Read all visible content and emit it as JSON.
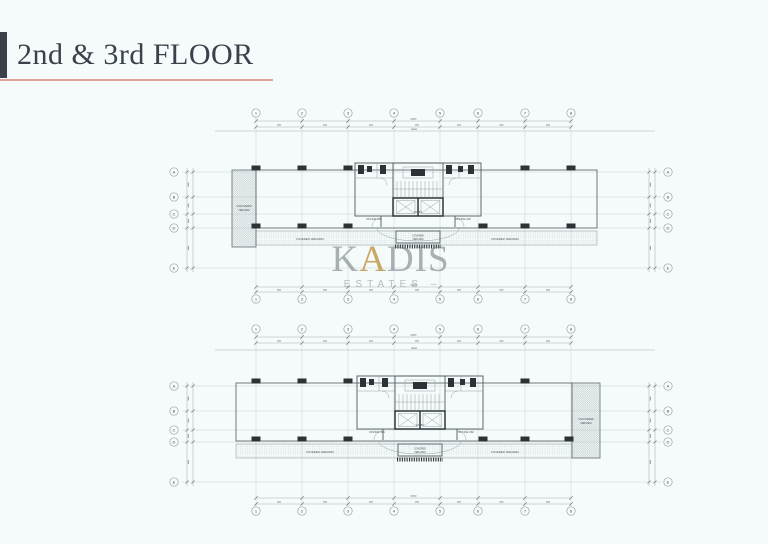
{
  "title": {
    "text": "2nd & 3rd FLOOR"
  },
  "watermark": {
    "word_start": "K",
    "word_gold": "A",
    "word_end": "DIS",
    "subtitle": "ESTATES",
    "dash": "–"
  },
  "colors": {
    "background": "#f5fafa",
    "title_text": "#3a414b",
    "title_bar": "#3a414b",
    "underline_accent": "#dda49e",
    "watermark_gray": "#6a727a",
    "watermark_gold": "#bb9440",
    "drawing_line": "#a7b1b6",
    "drawing_dark": "#2c3236"
  },
  "grid": {
    "columns": [
      "1",
      "2",
      "3",
      "4",
      "5",
      "6",
      "7",
      "8"
    ],
    "rows": [
      "A",
      "B",
      "C",
      "D",
      "E"
    ]
  },
  "plans": {
    "top": {
      "labels": {
        "uncovered_line1": "UNCOVERED",
        "uncovered_line2": "VERANDA",
        "covered_veranda": "COVERED VERANDA",
        "office_left": "OFFICE 201",
        "office_right": "OFFICE 202",
        "lobby": "LOBBY",
        "core_veranda_1": "COVERED",
        "core_veranda_2": "VERANDA"
      }
    },
    "bottom": {
      "labels": {
        "uncovered_line1": "UNCOVERED",
        "uncovered_line2": "VERANDA",
        "covered_veranda": "COVERED VERANDA",
        "office_left": "OFFICE 301",
        "office_right": "OFFICE 302",
        "lobby": "LOBBY",
        "core_veranda_1": "COVERED",
        "core_veranda_2": "VERANDA"
      }
    }
  }
}
